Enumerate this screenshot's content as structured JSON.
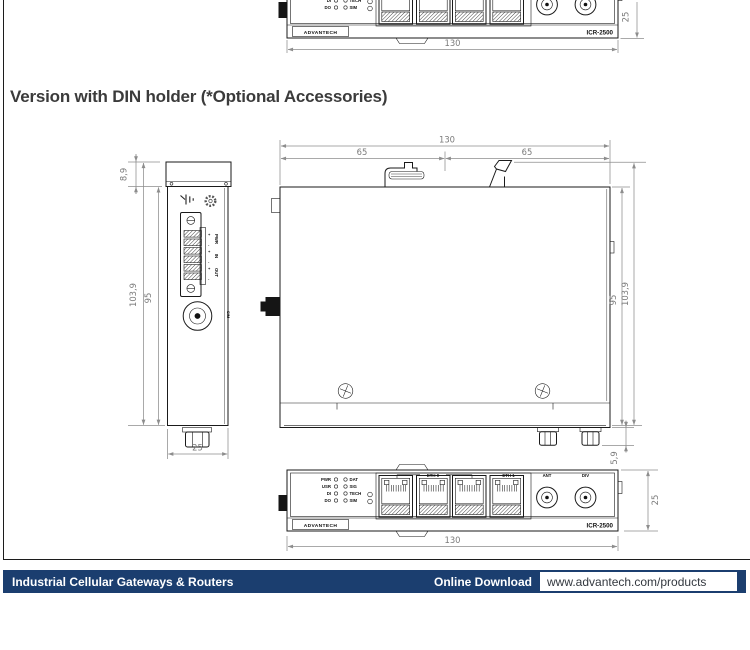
{
  "title": "Version with DIN holder (*Optional Accessories)",
  "footer": {
    "left_label": "Industrial Cellular Gateways & Routers",
    "download_label": "Online Download",
    "url": "www.advantech.com/products",
    "bar_color": "#1b3e6f"
  },
  "device": {
    "brand": "ADVANTECH",
    "model": "ICR-2500",
    "leds_left": [
      "PWR",
      "USR",
      "DI",
      "DO"
    ],
    "leds_right": [
      "DAT",
      "SIG",
      "TECH",
      "SIM"
    ],
    "ports": {
      "eth0": "ETH 0",
      "eth1": "ETH 1",
      "ant": "ANT",
      "div": "DIV"
    },
    "side": {
      "rows": [
        "PWR",
        "IN",
        "OUT"
      ],
      "plus": "+",
      "minus": "-",
      "sim": "SIM"
    }
  },
  "dims": {
    "width": "130",
    "half": "65",
    "depth": "25",
    "body": "95",
    "total": "103,9",
    "din": "8,9",
    "stub": "5,9"
  }
}
